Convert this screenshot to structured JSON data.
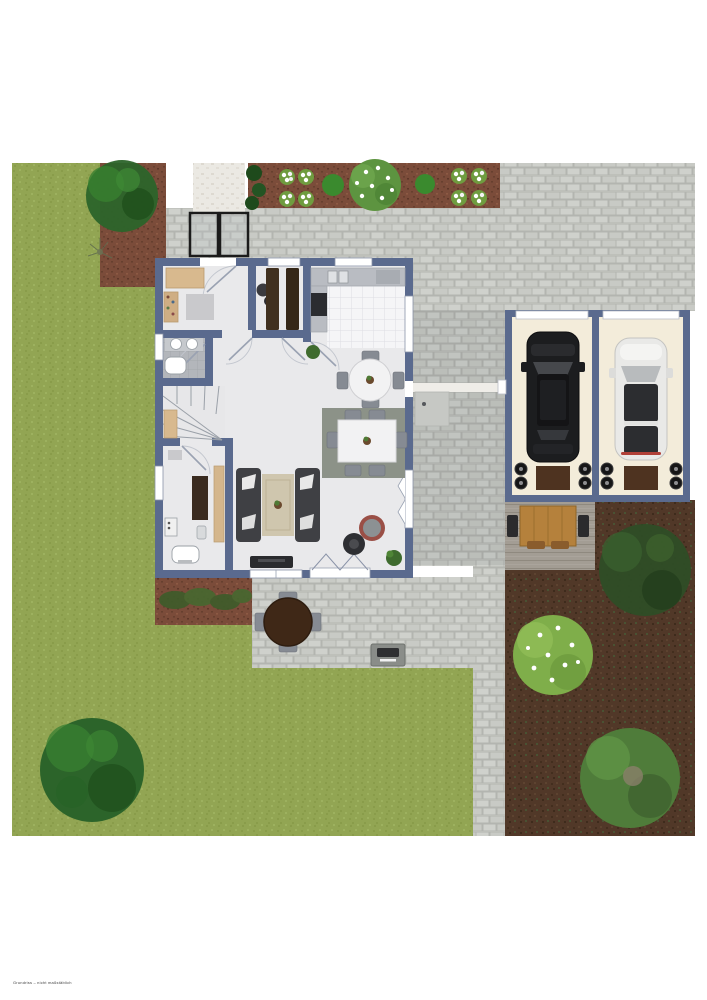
{
  "plan": {
    "type": "residential site and ground-floor plan, top-down view",
    "caption": "Grundriss – nicht maßstäblich",
    "rooms": [
      {
        "name": "entrance-hall",
        "features": [
          "entrance-door",
          "sideboard",
          "shoe-shelf",
          "doormat"
        ]
      },
      {
        "name": "pantry",
        "features": [
          "two-shelving-units",
          "coat-stand",
          "window"
        ]
      },
      {
        "name": "kitchen",
        "features": [
          "counter-with-sink",
          "cooktop",
          "white-tile-floor",
          "two-windows"
        ]
      },
      {
        "name": "bathroom",
        "features": [
          "double-sink",
          "bathtub",
          "window",
          "gray-tile-floor"
        ]
      },
      {
        "name": "staircase",
        "features": [
          "winder-stairs"
        ]
      },
      {
        "name": "utility-room",
        "features": [
          "desk",
          "cabinet",
          "washbasin",
          "window"
        ]
      },
      {
        "name": "dining-nook",
        "features": [
          "round-table",
          "4-chairs",
          "plant"
        ]
      },
      {
        "name": "living-dining-room",
        "features": [
          "dining-table-6-chairs",
          "two-sofas",
          "rug",
          "tv-console",
          "armchair",
          "side-table",
          "folding-patio-door",
          "casement-windows",
          "plants"
        ]
      }
    ],
    "garage": {
      "bays": 2,
      "vehicles": [
        "black-car",
        "white-car"
      ],
      "items": [
        "wheel-stacks",
        "storage-mats",
        "garage-doors"
      ]
    },
    "garden": {
      "areas": [
        "lawn-west",
        "lawn-south",
        "paved-driveway",
        "paver-patio",
        "white-entry-walkway",
        "mulch-bed-northwest",
        "mulch-strip-north",
        "planting-bed-south",
        "soil-garden-southeast",
        "wood-deck-terrace"
      ],
      "plants": [
        "large-bush-northwest",
        "twig-plant",
        "flower-clusters",
        "flowering-shrub-north",
        "small-bushes",
        "lawn-tree-southwest",
        "dark-bush-southeast",
        "flowering-bush-southeast",
        "tree-southeast",
        "bed-perennials"
      ],
      "furniture": [
        "terrace-wood-table-set",
        "patio-round-table-4-chairs",
        "grill"
      ]
    }
  },
  "colors": {
    "wall": "#5a6a8e",
    "floor": "#e9e9eb",
    "grass1": "#92a553",
    "grass2": "#899c4a",
    "grass3": "#9db15f",
    "paver": "#c8cac5",
    "paverLine": "#b3b5b0",
    "paverAlt": "#cfd1cc",
    "mulch": "#7b4c3a",
    "mulchDot": "#67402f",
    "soil": "#513828",
    "soilDot": "#432e1e",
    "walkway": "#ebe9e3",
    "deck": "#a39d94",
    "deckLine": "#8f897f",
    "garageFloor": "#f3ecda",
    "tile": "#f5f5f7",
    "tileLine": "#dddde3",
    "bathTile": "#b3b6bb",
    "bathTileLine": "#a2a5aa",
    "tan": "#d8b98e",
    "darkWood": "#40301f",
    "counter": "#b9bcc2",
    "stove": "#2b2c30",
    "sofa": "#3f4044",
    "rugBeige": "#cfc6ae",
    "rugGreen": "#8c9288",
    "chair": "#868b93",
    "tableWhite": "#f2f2f3",
    "carBlack": "#1c1d1f",
    "carWhite": "#e9e9e7",
    "woodTable": "#b5813c",
    "patioTable": "#3f2817",
    "bushDark": "#2e5a26",
    "bushMid": "#3a8a2e",
    "bushLight": "#7fae4a",
    "treeGreen": "#2c642a"
  }
}
